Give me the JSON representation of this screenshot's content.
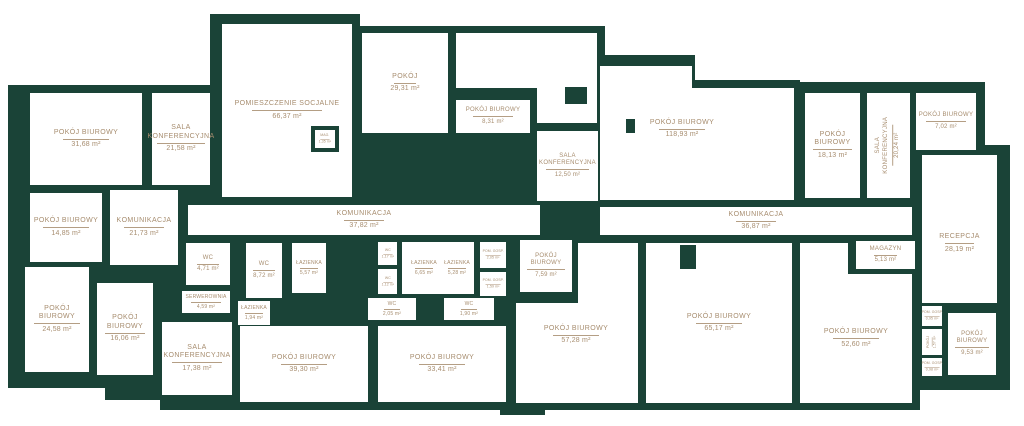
{
  "plan": {
    "type": "office-floor-plan",
    "colors": {
      "wall": "#1a4337",
      "label": "#a78d6f",
      "floor": "#ffffff"
    },
    "rooms": [
      {
        "id": "pokoj-biurowy-31-68",
        "name": "POKÓJ BIUROWY",
        "area": "31,68 m²"
      },
      {
        "id": "sala-konferencyjna-21-58",
        "name": "SALA KONFERENCYJNA",
        "area": "21,58 m²"
      },
      {
        "id": "pomieszczenie-socjalne-66-37",
        "name": "POMIESZCZENIE SOCJALNE",
        "area": "66,37 m²"
      },
      {
        "id": "mag-1-35",
        "name": "MAG.",
        "area": "1,35 m²"
      },
      {
        "id": "pokoj-29-31",
        "name": "POKÓJ",
        "area": "29,31 m²"
      },
      {
        "id": "pokoj-biurowy-8-31",
        "name": "POKÓJ BIUROWY",
        "area": "8,31 m²"
      },
      {
        "id": "sala-konferencyjna-12-50",
        "name": "SALA KONFERENCYJNA",
        "area": "12,50 m²"
      },
      {
        "id": "pokoj-biurowy-118-93",
        "name": "POKÓJ BIUROWY",
        "area": "118,93 m²"
      },
      {
        "id": "pokoj-biurowy-18-13",
        "name": "POKÓJ BIUROWY",
        "area": "18,13 m²"
      },
      {
        "id": "sala-konferencyjna-20-24",
        "name": "SALA KONFERENCYJNA",
        "area": "20,24 m²"
      },
      {
        "id": "pokoj-biurowy-7-02",
        "name": "POKÓJ BIUROWY",
        "area": "7,02 m²"
      },
      {
        "id": "komunikacja-21-73",
        "name": "KOMUNIKACJA",
        "area": "21,73 m²"
      },
      {
        "id": "komunikacja-37-82",
        "name": "KOMUNIKACJA",
        "area": "37,82 m²"
      },
      {
        "id": "komunikacja-36-87",
        "name": "KOMUNIKACJA",
        "area": "36,87 m²"
      },
      {
        "id": "pokoj-biurowy-14-85",
        "name": "POKÓJ BIUROWY",
        "area": "14,85 m²"
      },
      {
        "id": "pokoj-biurowy-24-58",
        "name": "POKÓJ BIUROWY",
        "area": "24,58 m²"
      },
      {
        "id": "pokoj-biurowy-16-06",
        "name": "POKÓJ BIUROWY",
        "area": "16,06 m²"
      },
      {
        "id": "sala-konferencyjna-17-38",
        "name": "SALA KONFERENCYJNA",
        "area": "17,38 m²"
      },
      {
        "id": "wc-4-71",
        "name": "WC",
        "area": "4,71 m²"
      },
      {
        "id": "serwerownia-4-59",
        "name": "SERWEROWNIA",
        "area": "4,59 m²"
      },
      {
        "id": "wc-8-72",
        "name": "WC",
        "area": "8,72 m²"
      },
      {
        "id": "lazienka-1-94",
        "name": "ŁAZIENKA",
        "area": "1,94 m²"
      },
      {
        "id": "lazienka-5-57",
        "name": "ŁAZIENKA",
        "area": "5,57 m²"
      },
      {
        "id": "wc-1-17",
        "name": "WC",
        "area": "1,17 m²"
      },
      {
        "id": "wc-1-12",
        "name": "WC",
        "area": "1,12 m²"
      },
      {
        "id": "lazienka-6-65",
        "name": "ŁAZIENKA",
        "area": "6,65 m²"
      },
      {
        "id": "wc-2-05",
        "name": "WC",
        "area": "2,05 m²"
      },
      {
        "id": "lazienka-5-28",
        "name": "ŁAZIENKA",
        "area": "5,28 m²"
      },
      {
        "id": "wc-1-90",
        "name": "WC",
        "area": "1,90 m²"
      },
      {
        "id": "pom-gosp-2-05",
        "name": "POM. GOSP.",
        "area": "2,05 m²"
      },
      {
        "id": "pom-gosp-1-59",
        "name": "POM. GOSP.",
        "area": "1,59 m²"
      },
      {
        "id": "pokoj-biurowy-7-59",
        "name": "POKÓJ BIUROWY",
        "area": "7,59 m²"
      },
      {
        "id": "pokoj-biurowy-39-30",
        "name": "POKÓJ BIUROWY",
        "area": "39,30 m²"
      },
      {
        "id": "pokoj-biurowy-33-41",
        "name": "POKÓJ BIUROWY",
        "area": "33,41 m²"
      },
      {
        "id": "pokoj-biurowy-57-28",
        "name": "POKÓJ BIUROWY",
        "area": "57,28 m²"
      },
      {
        "id": "pokoj-biurowy-65-17",
        "name": "POKÓJ BIUROWY",
        "area": "65,17 m²"
      },
      {
        "id": "pokoj-biurowy-52-60",
        "name": "POKÓJ BIUROWY",
        "area": "52,60 m²"
      },
      {
        "id": "magazyn-5-13",
        "name": "MAGAZYN",
        "area": "5,13 m²"
      },
      {
        "id": "recepcja-28-19",
        "name": "RECEPCJA",
        "area": "28,19 m²"
      },
      {
        "id": "pom-gosp-0-95",
        "name": "POM. GOSP.",
        "area": "0,95 m²"
      },
      {
        "id": "pokoj-1-57",
        "name": "POKÓJ",
        "area": "1,57 m²"
      },
      {
        "id": "pom-gosp-0-98",
        "name": "POM. GOSP.",
        "area": "0,98 m²"
      },
      {
        "id": "pokoj-biurowy-9-53",
        "name": "POKÓJ BIUROWY",
        "area": "9,53 m²"
      }
    ]
  }
}
